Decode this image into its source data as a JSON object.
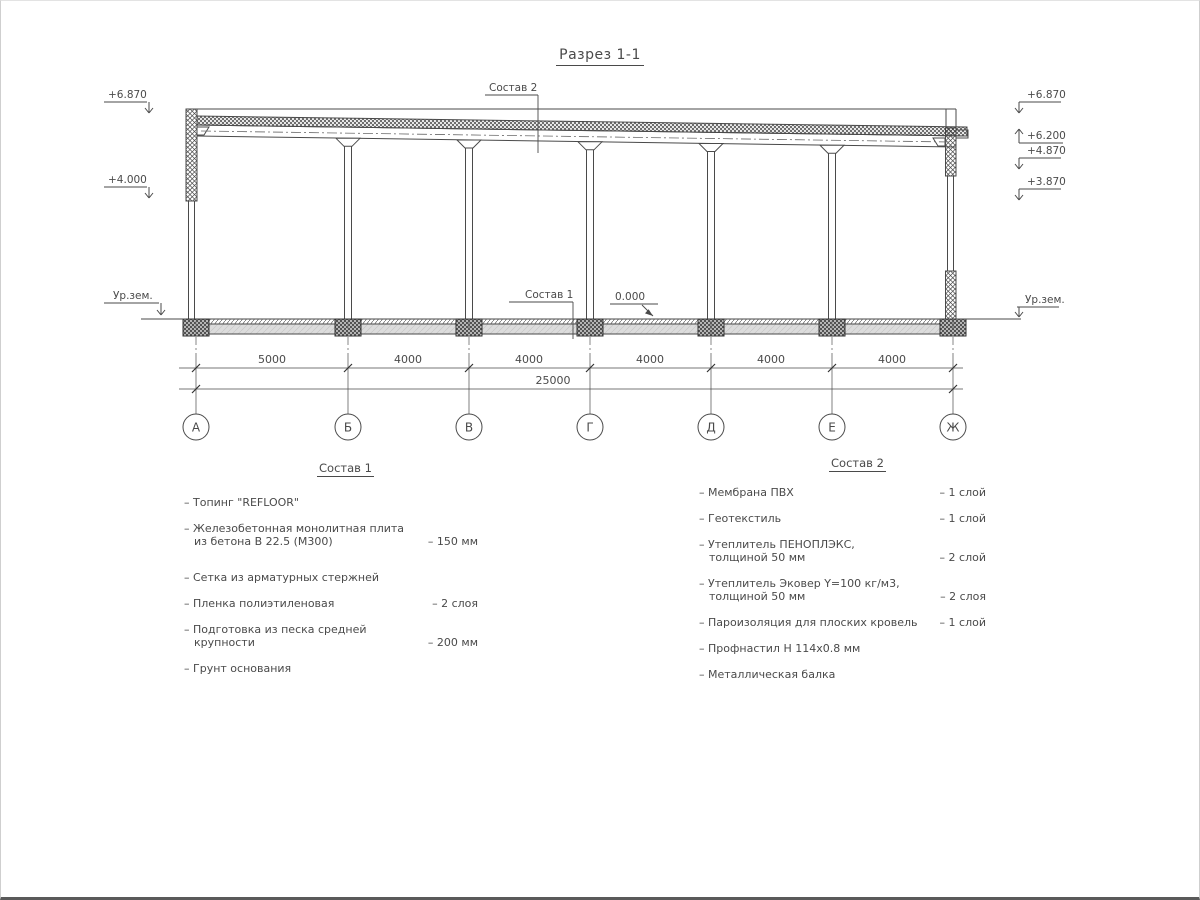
{
  "page": {
    "title": "Разрез 1-1"
  },
  "drawing": {
    "callout_top": "Состав 2",
    "callout_floor": "Состав 1",
    "zero_level": "0.000",
    "ground_level_label": "Ур.зем.",
    "elevations_left": [
      "+6.870",
      "+4.000"
    ],
    "elevations_right": [
      "+6.870",
      "+6.200",
      "+4.870",
      "+3.870"
    ],
    "grid_axes": [
      "А",
      "Б",
      "В",
      "Г",
      "Д",
      "Е",
      "Ж"
    ],
    "span_dimensions": [
      "5000",
      "4000",
      "4000",
      "4000",
      "4000",
      "4000"
    ],
    "overall_dimension": "25000"
  },
  "sostav1": {
    "heading": "Состав 1",
    "items": [
      {
        "text": "– Топинг \"REFLOOR\"",
        "value": ""
      },
      {
        "text": "– Железобетонная  монолитная плита\nиз бетона В 22.5 (М300)",
        "value": "– 150 мм"
      },
      {
        "text": "– Сетка из арматурных стержней",
        "value": ""
      },
      {
        "text": "– Пленка полиэтиленовая",
        "value": "–  2 слоя"
      },
      {
        "text": "– Подготовка из песка средней\nкрупности",
        "value": "– 200 мм"
      },
      {
        "text": "– Грунт основания",
        "value": ""
      }
    ]
  },
  "sostav2": {
    "heading": "Состав 2",
    "items": [
      {
        "text": "– Мембрана ПВХ",
        "value": "– 1 слой"
      },
      {
        "text": "– Геотекстиль",
        "value": "– 1 слой"
      },
      {
        "text": "– Утеплитель ПЕНОПЛЭКС,\nтолщиной 50 мм",
        "value": "– 2 слой"
      },
      {
        "text": "– Утеплитель Эковер Y=100 кг/м3,\nтолщиной 50 мм",
        "value": "– 2 слоя"
      },
      {
        "text": "– Пароизоляция для плоских кровель",
        "value": "– 1 слой"
      },
      {
        "text": "– Профнастил Н 114х0.8 мм",
        "value": ""
      },
      {
        "text": "– Металлическая балка",
        "value": ""
      }
    ]
  }
}
